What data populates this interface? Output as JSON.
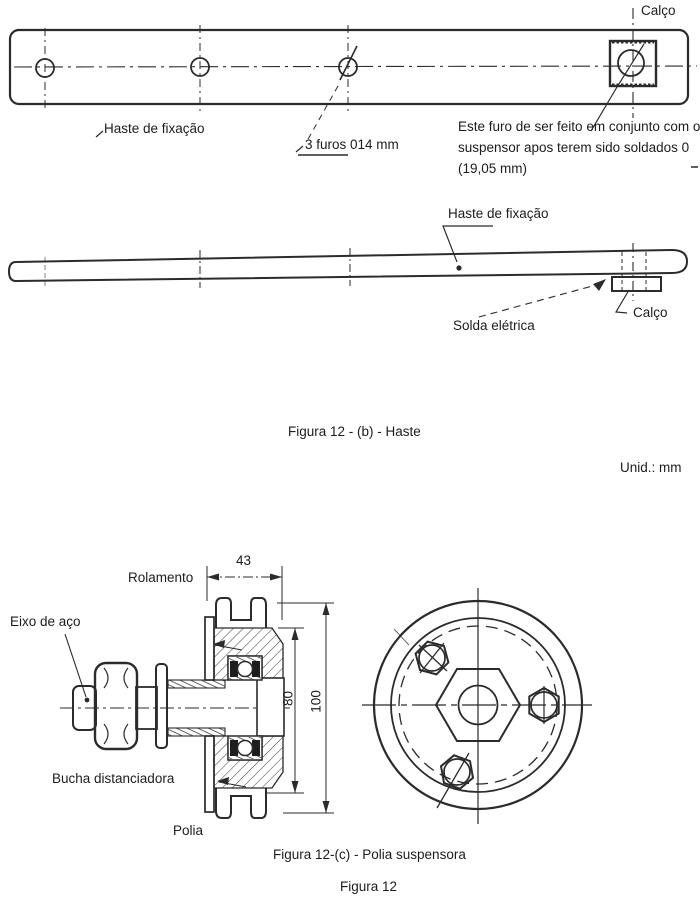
{
  "colors": {
    "ink": "#2b2b2b",
    "paper": "#ffffff"
  },
  "top_view": {
    "calco_label": "Calço",
    "haste_label": "Haste de fixação",
    "holes_note": "3 furos 014 mm",
    "weld_note": "Este furo de ser feito em conjunto com o suspensor apos terem sido soldados 0 (19,05 mm)"
  },
  "side_view": {
    "haste_label": "Haste de fixação",
    "solda_label": "Solda elétrica",
    "calco_label": "Calço"
  },
  "section_view": {
    "rolamento_label": "Rolamento",
    "eixo_label": "Eixo de aço",
    "bucha_label": "Bucha distanciadora",
    "polia_label": "Polia",
    "dim_43": "43",
    "dim_80": "80",
    "dim_100": "100"
  },
  "captions": {
    "figure_b": "Figura 12 - (b) - Haste",
    "unit": "Unid.: mm",
    "figure_c": "Figura 12-(c) - Polia suspensora",
    "figure_main": "Figura 12"
  }
}
